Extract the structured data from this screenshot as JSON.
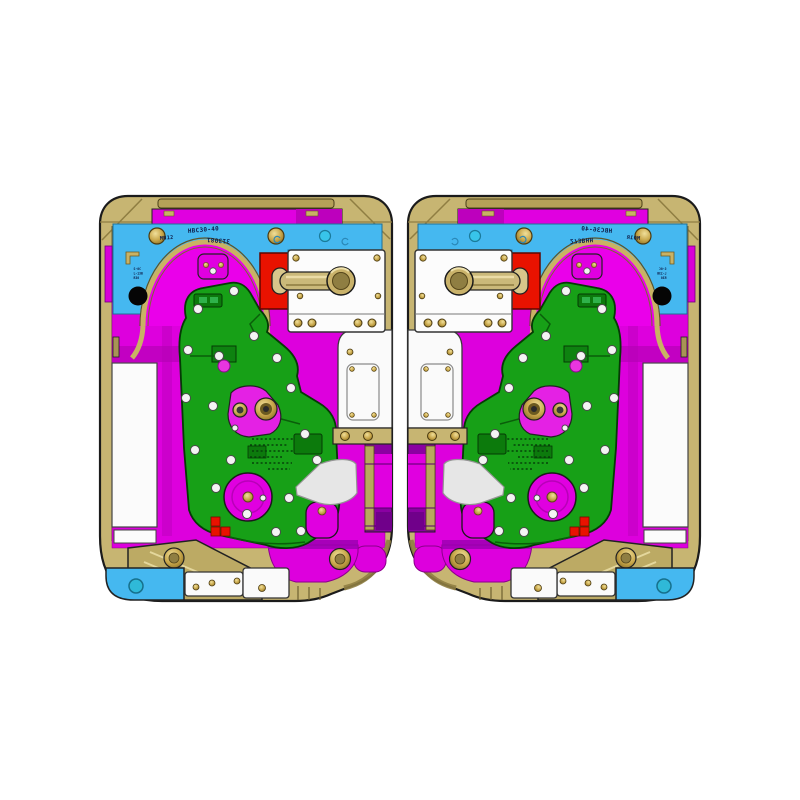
{
  "meta": {
    "description": "3D CAD rendering of two mirrored die-cast mold half assemblies shown side by side on a white background",
    "image_type": "product render"
  },
  "palette": {
    "background": "#FFFFFF",
    "mold_base_tan": "#C7B572",
    "mold_base_tan_dark": "#8F7E42",
    "cavity_plate_magenta": "#DD00DD",
    "dome_magenta": "#EA00EA",
    "insert_green": "#17A017",
    "insert_green_dark": "#0C7A0C",
    "top_panel_blue": "#45B8F0",
    "slide_block_red": "#E81200",
    "hardware_gold": "#C9A84C",
    "plate_white": "#FBFBFB",
    "side_shadow_purple": "#8A00A2",
    "gate_gray": "#E6E6E6",
    "locating_dot_black": "#050505",
    "teal_screw": "#38C4EA"
  },
  "left_mold": {
    "engraving_prefix": "MN12",
    "engraving_model": "HBC30-40",
    "engraving_serial": "313081",
    "side_note_lines": [
      "S-0C",
      "L-13B",
      "R30"
    ]
  },
  "right_mold": {
    "engraving_prefix": "MO1R",
    "engraving_model": "HBC36-40",
    "engraving_serial": "273BHH",
    "side_note_lines": [
      "S-0C",
      "L-13B",
      "R30"
    ],
    "text_mirrored": true
  }
}
